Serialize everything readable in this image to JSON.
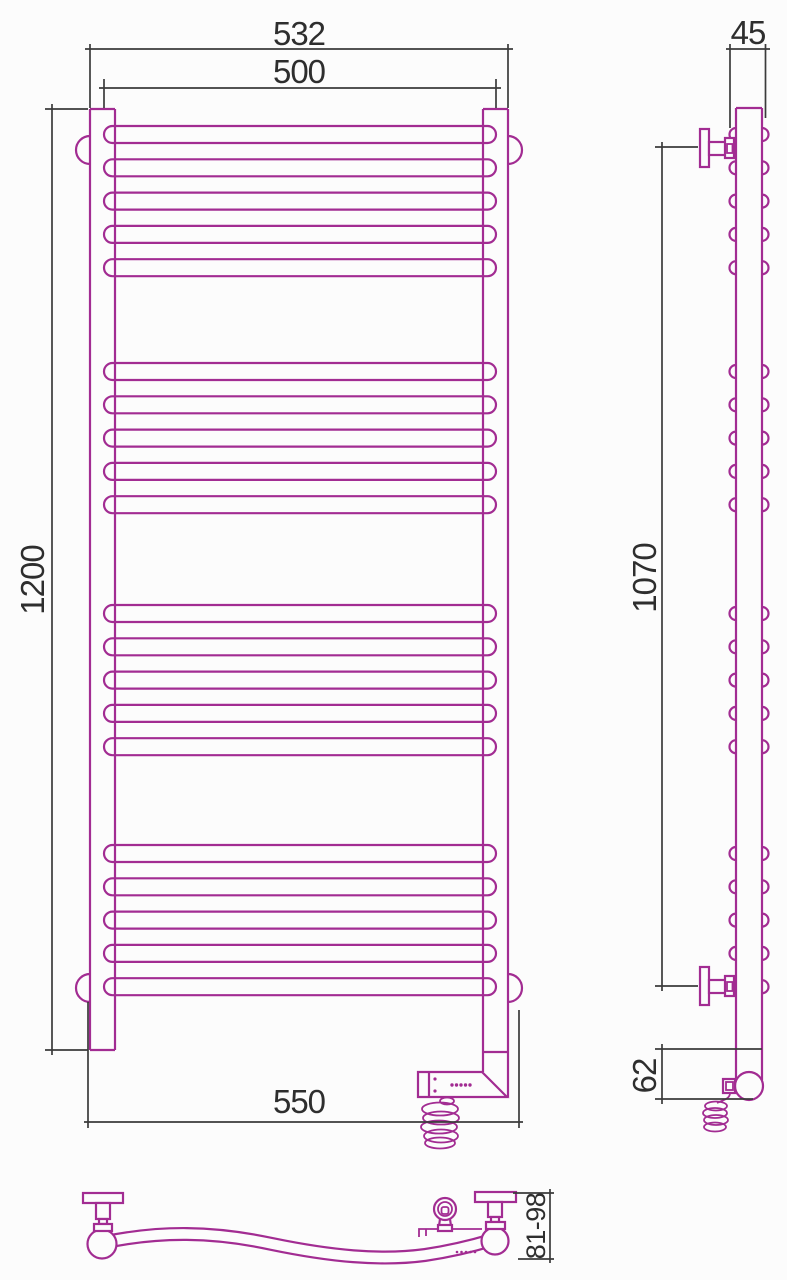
{
  "title": "Heated towel rail technical drawing",
  "colors": {
    "outline": "#A22C92",
    "dimension": "#3B3B3B",
    "text": "#2E2E2E",
    "background": "#FCFCFC"
  },
  "front_view": {
    "name": "front view",
    "dimensions": {
      "outer_width": "532",
      "rail_width": "500",
      "height": "1200",
      "base_width": "550"
    },
    "bars": {
      "group_tops": [
        126,
        363,
        605,
        845
      ],
      "per_group": 5,
      "pitch": 33.3,
      "height": 17,
      "x": 104,
      "width": 392,
      "radius": 8.5,
      "total": 20
    }
  },
  "side_view": {
    "name": "side view",
    "dimensions": {
      "depth": "45",
      "mount_span": "1070",
      "bottom_offset": "62"
    },
    "bump_radius": 6.5
  },
  "bottom_view": {
    "name": "bottom view",
    "dimensions": {
      "wall_distance": "81-98"
    }
  }
}
